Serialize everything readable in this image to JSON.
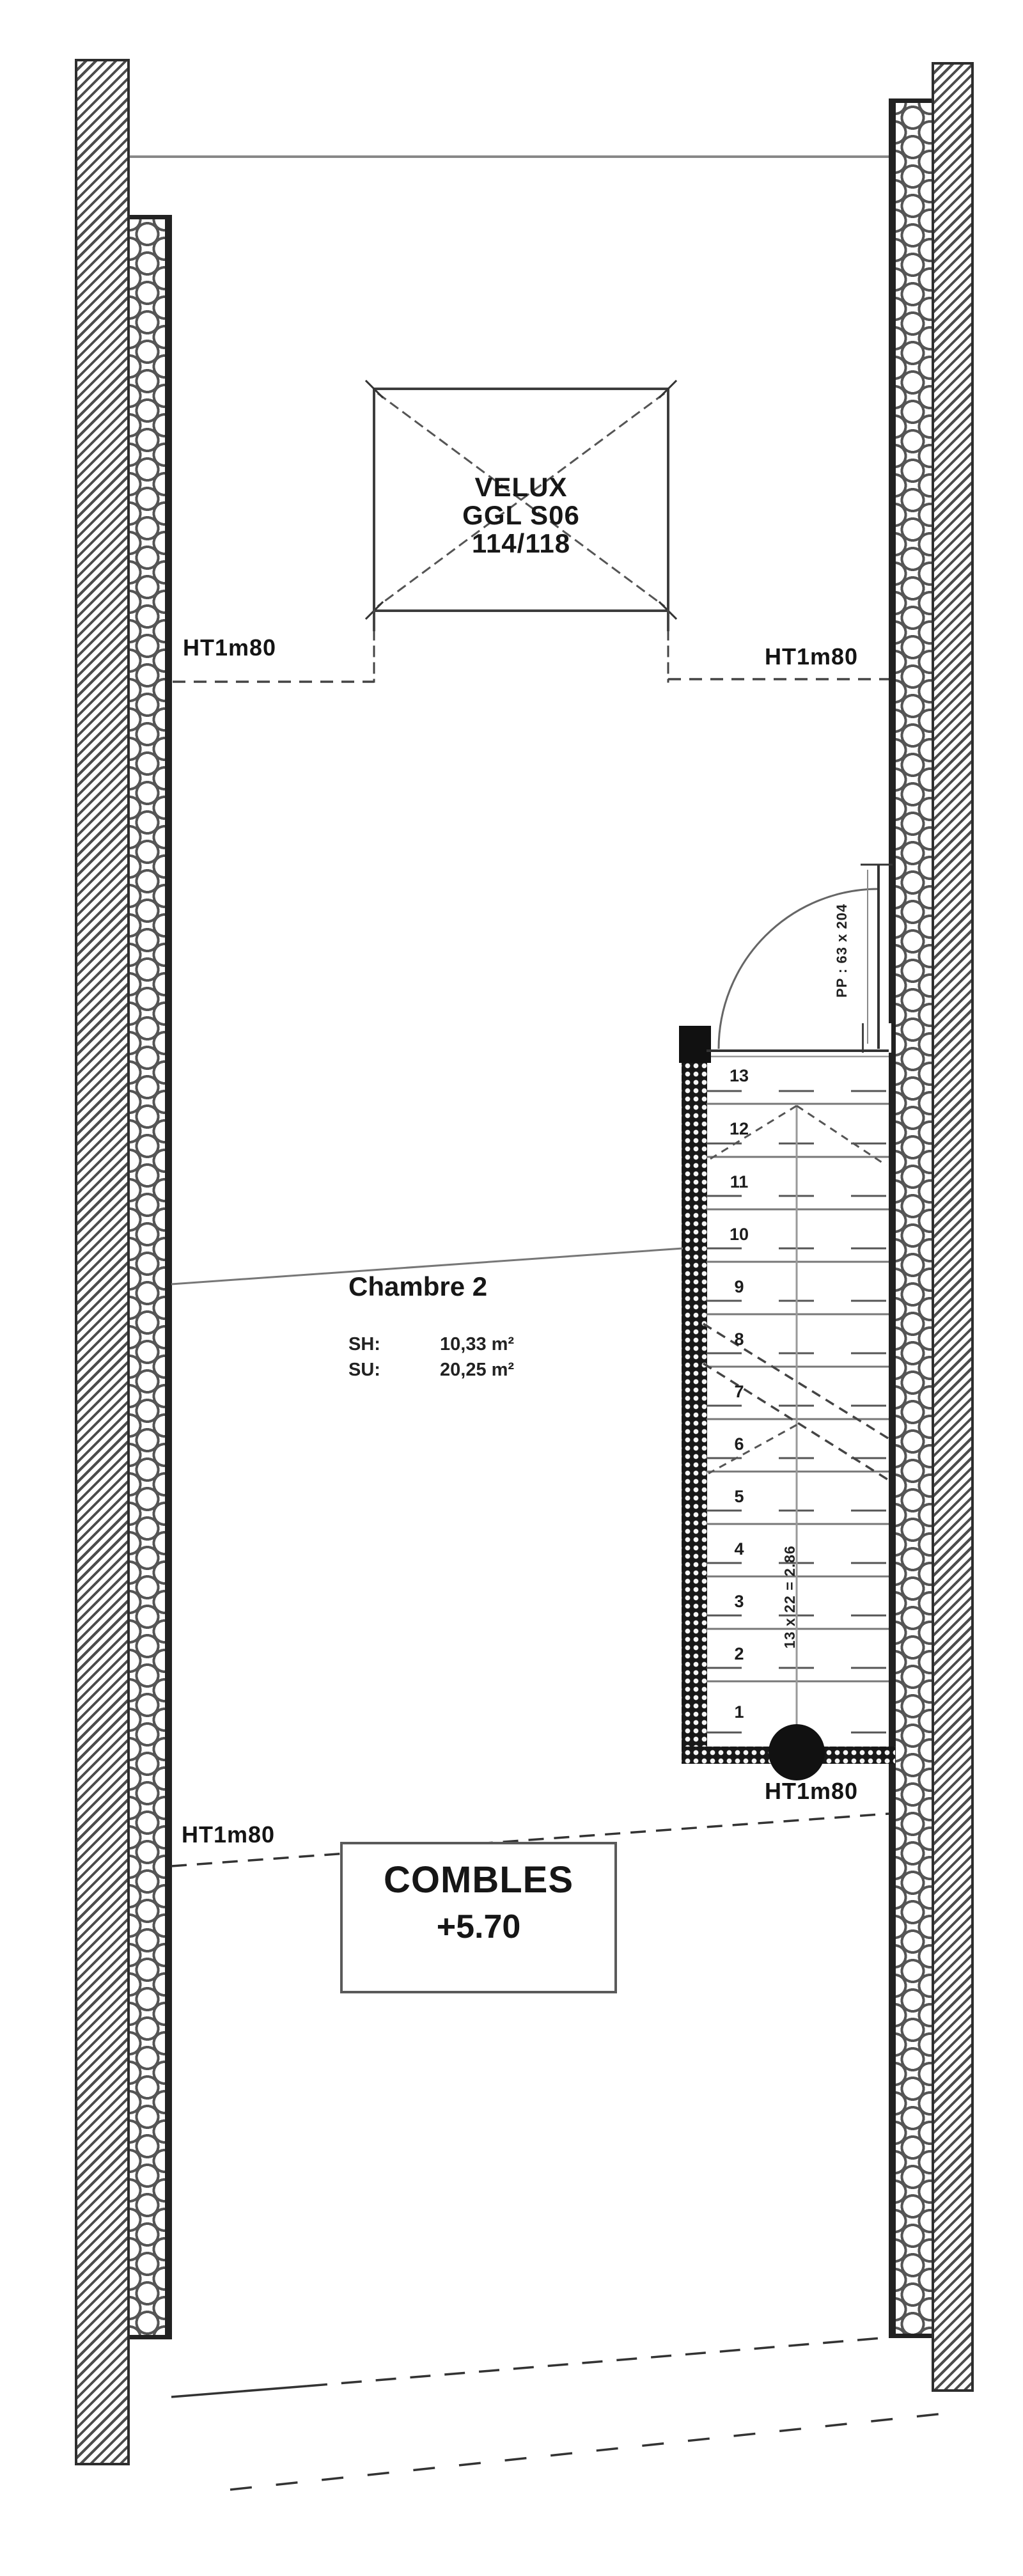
{
  "drawing": {
    "velux": {
      "line1": "VELUX",
      "line2": "GGL S06",
      "line3": "114/118"
    },
    "height_label": "HT1m80",
    "door_label": "PP : 63 x 204",
    "room": {
      "name": "Chambre 2",
      "sh_label": "SH:",
      "sh_value": "10,33 m²",
      "su_label": "SU:",
      "su_value": "20,25 m²"
    },
    "level": {
      "name": "COMBLES",
      "elevation": "+5.70"
    },
    "stairs": {
      "dimension": "13 x 22 = 2.86",
      "steps": [
        "13",
        "12",
        "11",
        "10",
        "9",
        "8",
        "7",
        "6",
        "5",
        "4",
        "3",
        "2",
        "1"
      ]
    },
    "colors": {
      "ink": "#1a1a1a",
      "line_gray": "#777777",
      "wall": "#4c4c4c"
    }
  }
}
